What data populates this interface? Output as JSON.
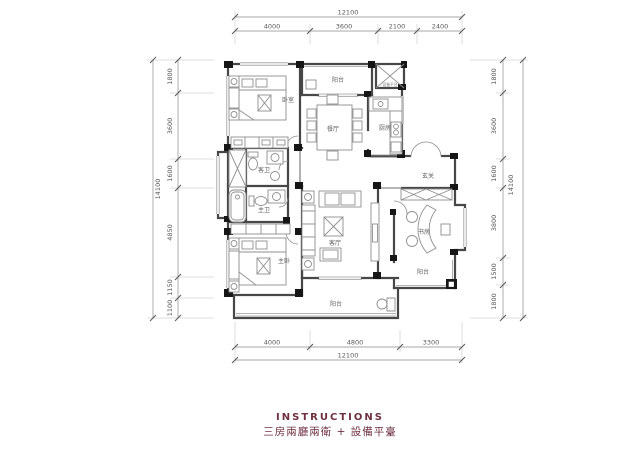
{
  "canvas": {
    "width": 640,
    "height": 451,
    "background": "#ffffff"
  },
  "colors": {
    "walls": "#474747",
    "structure": "#161616",
    "dimension_text": "#5a5a5a",
    "caption_accent": "#6e3040"
  },
  "caption": {
    "title": "INSTRUCTIONS",
    "subtitle": "三房兩廳兩衛 + 設備平臺"
  },
  "rooms": {
    "bedroom": "卧室",
    "balcony_top": "阳台",
    "equipment": "设备平台",
    "dining": "餐厅",
    "kitchen": "厨房",
    "foyer": "玄关",
    "guest_bath": "客卫",
    "master_bath": "主卫",
    "living": "客厅",
    "study": "书房",
    "balcony_right": "阳台",
    "master_bedroom": "主卧",
    "balcony_bottom": "阳台"
  },
  "dimensions": {
    "top": {
      "total": "12100",
      "segments": [
        "4000",
        "3600",
        "2100",
        "2400"
      ]
    },
    "bottom": {
      "total": "12100",
      "segments": [
        "4000",
        "4800",
        "3300"
      ]
    },
    "left": {
      "total": "14100",
      "segments": [
        "1800",
        "3600",
        "1600",
        "4850",
        "1150",
        "1100"
      ]
    },
    "right": {
      "total": "14100",
      "segments": [
        "1800",
        "3600",
        "1600",
        "3800",
        "1500",
        "1800"
      ]
    }
  }
}
